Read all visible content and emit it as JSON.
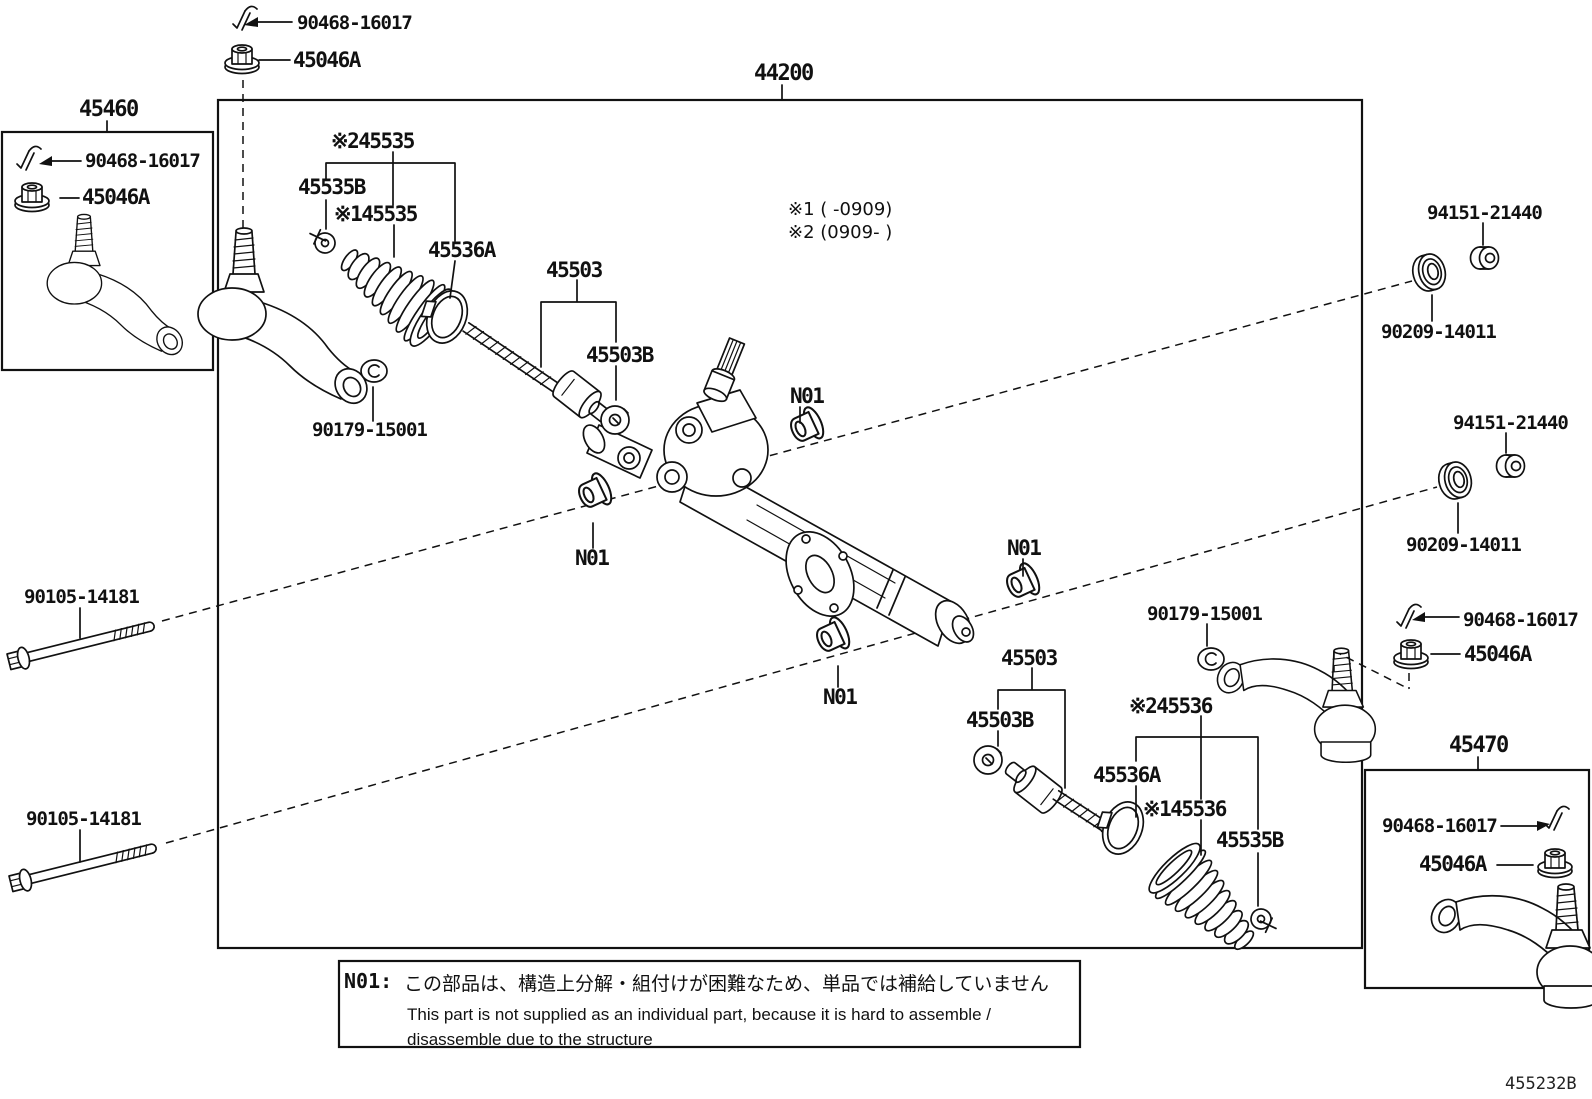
{
  "colors": {
    "ink": "#111111",
    "background": "#ffffff"
  },
  "assemblies": {
    "main": "44200",
    "tie_rod_lh": "45460",
    "tie_rod_rh": "45470"
  },
  "parts": {
    "cotter_pin": "90468-16017",
    "tie_rod_nut": "45046A",
    "boot_kit2_lh": "※245535",
    "boot_clamp": "45535B",
    "boot_kit1_lh": "※145535",
    "boot_clip": "45536A",
    "inner_rod": "45503",
    "rod_washer": "45503B",
    "bracket_nut": "94151-21440",
    "bracket_washer": "90209-14011",
    "not_supplied_tag": "N01",
    "rack_grommet": "90179-15001",
    "mount_bolt": "90105-14181",
    "boot_kit2_rh": "※245536",
    "boot_kit1_rh": "※145536"
  },
  "footnotes": {
    "f1": "※1 (    -0909)",
    "f2": "※2 (0909-    )"
  },
  "note": {
    "tag": "N01:",
    "jp": "この部品は、構造上分解・組付けが困難なため、単品では補給していません",
    "en1": "This part is not supplied as an individual part, because it is hard to assemble /",
    "en2": "disassemble  due to the structure"
  },
  "doc_code": "455232B"
}
